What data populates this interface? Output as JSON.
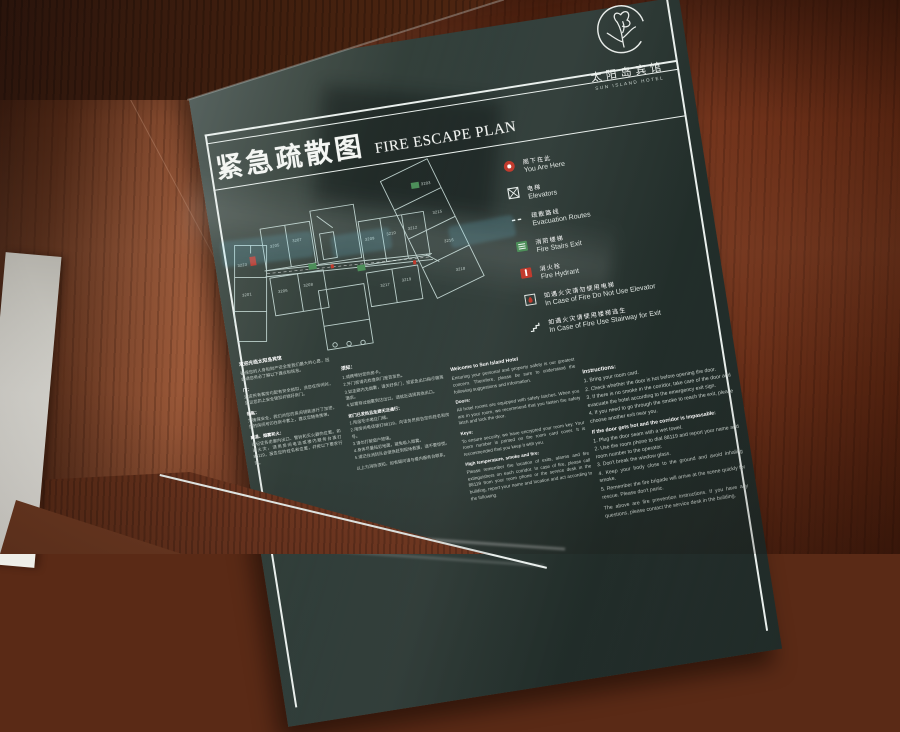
{
  "scene": {
    "description": "Photograph of a hotel fire escape plan sign mounted on a wooden wall",
    "panel_color": "#2b3835",
    "wood_color": "#7a3d24",
    "line_color": "#e9efec",
    "accent_red": "#c23b2e",
    "accent_green": "#4d8f5a"
  },
  "logo": {
    "icon": "lotus-flower-sketch",
    "name_cn": "太阳岛宾馆",
    "name_en": "SUN ISLAND HOTEL"
  },
  "title": {
    "cn": "紧急疏散图",
    "en": "FIRE ESCAPE PLAN"
  },
  "legend": {
    "items": [
      {
        "icon": "you-are-here-icon",
        "cn": "阁下在此",
        "en": "You Are Here"
      },
      {
        "icon": "elevator-icon",
        "cn": "电梯",
        "en": "Elevators"
      },
      {
        "icon": "dashed-route-icon",
        "cn": "疏散路线",
        "en": "Evacuation Routes"
      },
      {
        "icon": "fire-stairs-icon",
        "cn": "消防楼梯",
        "en": "Fire Stairs Exit"
      },
      {
        "icon": "fire-hydrant-icon",
        "cn": "消火栓",
        "en": "Fire Hydrant"
      },
      {
        "icon": "no-elevator-icon",
        "cn": "如遇火灾请勿使用电梯",
        "en": "In Case of Fire Do Not Use Elevator"
      },
      {
        "icon": "stairway-exit-icon",
        "cn": "如遇火灾请使用楼梯逃生",
        "en": "In Case of Fire Use Stairway for Exit"
      }
    ]
  },
  "floor_plan": {
    "markers": {
      "you_are_here": "red dot in left wing",
      "fire_stairs": "green squares",
      "hydrant": "red squares"
    },
    "rooms": [
      {
        "label": "3223",
        "x": 12,
        "y": 74
      },
      {
        "label": "3201",
        "x": 12,
        "y": 104
      },
      {
        "label": "3205",
        "x": 47,
        "y": 60
      },
      {
        "label": "3207",
        "x": 70,
        "y": 58
      },
      {
        "label": "3209",
        "x": 142,
        "y": 68
      },
      {
        "label": "3210",
        "x": 164,
        "y": 66
      },
      {
        "label": "3212",
        "x": 186,
        "y": 64
      },
      {
        "label": "3206",
        "x": 48,
        "y": 106
      },
      {
        "label": "3208",
        "x": 74,
        "y": 104
      },
      {
        "label": "3217",
        "x": 150,
        "y": 116
      },
      {
        "label": "3219",
        "x": 172,
        "y": 114
      },
      {
        "label": "3203",
        "x": 206,
        "y": 22
      },
      {
        "label": "3215",
        "x": 213,
        "y": 52
      },
      {
        "label": "3216",
        "x": 220,
        "y": 82
      },
      {
        "label": "3218",
        "x": 227,
        "y": 112
      }
    ]
  },
  "info": {
    "cn_welcome": {
      "heading": "欢迎光临太阳岛宾馆",
      "intro": "确保您的人身和财产安全是我们最大的心愿，因此请您务必了解以下建议和信息。",
      "sections": [
        {
          "head": "门：",
          "body": "酒店所有客房均配有安全锁扣，当您在房间时，建议您扣上安全锁扣并锁好房门。"
        },
        {
          "head": "钥匙：",
          "body": "为确保安全，我们对您的房间钥匙进行了加密，您的房间号印在房卡套上，建议您随身携带。"
        },
        {
          "head": "高温、烟雾和火：",
          "body": "请记住各走廊内出口、警铃和灭火器的位置。如遇火灾，请用房间电话或楼内服务台拨打88119，报告您的姓名和位置，并按以下要求行动。"
        }
      ]
    },
    "cn_instructions": {
      "heading": "须知：",
      "items": [
        "1.请携带好您的房卡。",
        "2.开门前请先检查房门是否发热。",
        "3.如走廊内无烟雾，请关好房门，按紧急出口指示撤离酒店。",
        "4.如需穿过烟雾到达出口，请就近选择其他出口。"
      ],
      "subheading": "如门已发热且走廊无法通行：",
      "sub_items": [
        "1.用湿毛巾堵住门缝。",
        "2.用房间电话拨打88119，向话务员报告您的姓名和房号。",
        "3.请勿打破窗户玻璃。",
        "4.身体尽量贴近地面，避免吸入烟雾。",
        "5.请记住消防队会很快赶到现场救援，请不要惊慌。"
      ],
      "footer": "以上为消防须知，如有疑问请与楼内服务台联系。"
    },
    "en_welcome": {
      "heading": "Welcome to Sun Island Hotel",
      "intro": "Ensuring your personal and property safety is our greatest concern. Therefore, please be sure to understand the following suggestions and information.",
      "sections": [
        {
          "head": "Doors:",
          "body": "All hotel rooms are equipped with safety latches. When you are in your room, we recommend that you fasten the safety latch and lock the door."
        },
        {
          "head": "Keys:",
          "body": "To ensure security, we have encrypted your room key. Your room number is printed on the room card cover. It is recommended that you keep it with you."
        },
        {
          "head": "High temperature, smoke and fire:",
          "body": "Please remember the location of exits, alarms and fire extinguishers on each corridor. In case of fire, please call 88119 from your room phone or the service desk in the building, report your name and location and act according to the following."
        }
      ]
    },
    "en_instructions": {
      "heading": "Instructions:",
      "items": [
        "1. Bring your room card.",
        "2. Check whether the door is hot before opening the door.",
        "3. If there is no smoke in the corridor, take care of the door and evacuate the hotel according to the emergency exit sign.",
        "4. If you need to go through the smoke to reach the exit, please choose another exit near you."
      ],
      "subheading": "If the door gets hot and the corridor is impassable:",
      "sub_items": [
        "1. Plug the door seam with a wet towel.",
        "2. Use the room phone to dial 88119 and report your name and room number to the operator.",
        "3. Don't break the window glass.",
        "4. Keep your body close to the ground and avoid inhaling smoke.",
        "5. Remember the fire brigade will arrive at the scene quickly for rescue. Please don't panic."
      ],
      "footer": "The above are fire prevention instructions. If you have any questions, please contact the service desk in the building."
    }
  }
}
